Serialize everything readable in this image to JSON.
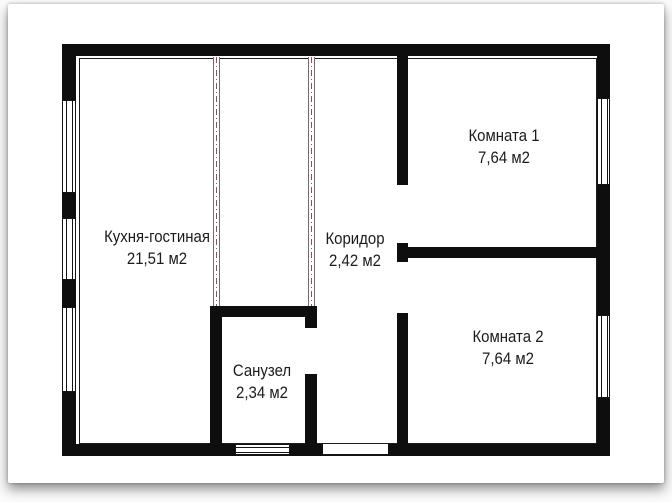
{
  "colors": {
    "wall": "#0e0e0e",
    "partition_dash": "#9b4d4d",
    "text": "#1b1b1b"
  },
  "floor_plan": {
    "rooms": [
      {
        "name": "Кухня-гостиная",
        "area": "21,51 м2"
      },
      {
        "name": "Коридор",
        "area": "2,42 м2"
      },
      {
        "name": "Санузел",
        "area": "2,34 м2"
      },
      {
        "name": "Комната 1",
        "area": "7,64 м2"
      },
      {
        "name": "Комната 2",
        "area": "7,64 м2"
      }
    ]
  }
}
